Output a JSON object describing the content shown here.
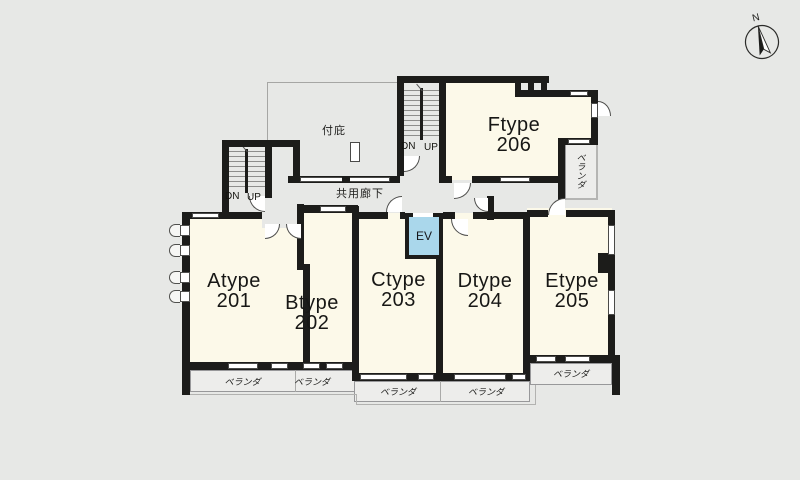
{
  "compass": {
    "north_label": "N"
  },
  "canopy": {
    "label": "付庇"
  },
  "corridor": {
    "label": "共用廊下"
  },
  "elevator": {
    "label": "EV"
  },
  "stairwells": {
    "left": {
      "down_label": "DN",
      "up_label": "UP"
    },
    "right": {
      "down_label": "DN",
      "up_label": "UP"
    }
  },
  "rooms": [
    {
      "type": "Atype",
      "number": "201"
    },
    {
      "type": "Btype",
      "number": "202"
    },
    {
      "type": "Ctype",
      "number": "203"
    },
    {
      "type": "Dtype",
      "number": "204"
    },
    {
      "type": "Etype",
      "number": "205"
    },
    {
      "type": "Ftype",
      "number": "206"
    }
  ],
  "balconies": {
    "atype": {
      "label": "ベランダ"
    },
    "btype": {
      "label": "ベランダ"
    },
    "ctype": {
      "label": "ベランダ"
    },
    "dtype": {
      "label": "ベランダ"
    },
    "etype": {
      "label": "ベランダ"
    },
    "ftype": {
      "label": "ベランダ"
    }
  },
  "colors": {
    "background": "#e7e8e6",
    "wall": "#1c1c1a",
    "room_fill": "#fcf9e9",
    "elevator_fill": "#aad7eb",
    "balcony_fill": "#ededeb"
  }
}
